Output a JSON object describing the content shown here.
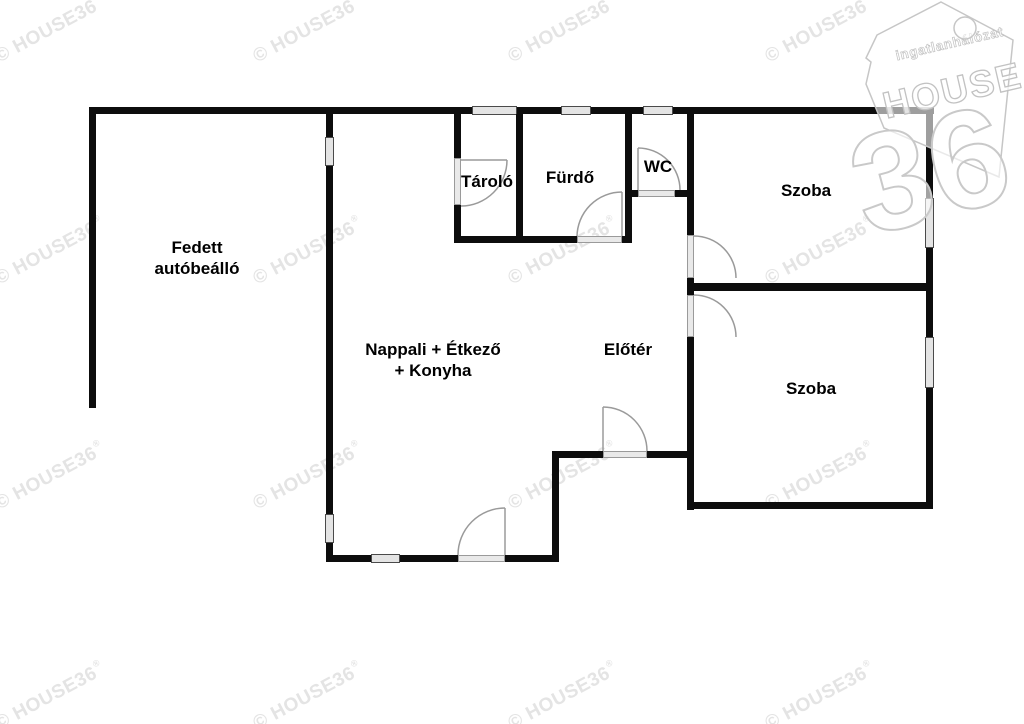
{
  "rooms": {
    "carport": {
      "line1": "Fedett",
      "line2": "autóbeálló"
    },
    "storage": {
      "label": "Tároló"
    },
    "bathroom": {
      "label": "Fürdő"
    },
    "wc": {
      "label": "WC"
    },
    "room_top": {
      "label": "Szoba"
    },
    "room_bottom": {
      "label": "Szoba"
    },
    "living": {
      "line1": "Nappali + Étkező",
      "line2": "+ Konyha"
    },
    "hall": {
      "label": "Előtér"
    }
  },
  "watermark": {
    "text": "© HOUSE36",
    "registered": "®"
  },
  "logo": {
    "network": "ingatlanhálózat",
    "brand": "HOUSE",
    "number": "36"
  },
  "colors": {
    "wall": "#0d0d0d",
    "window_fill": "#e4e4e4",
    "door_arc": "#9a9a9a",
    "watermark": "#e4e4e4",
    "logo_outline": "#c6c6c6"
  }
}
